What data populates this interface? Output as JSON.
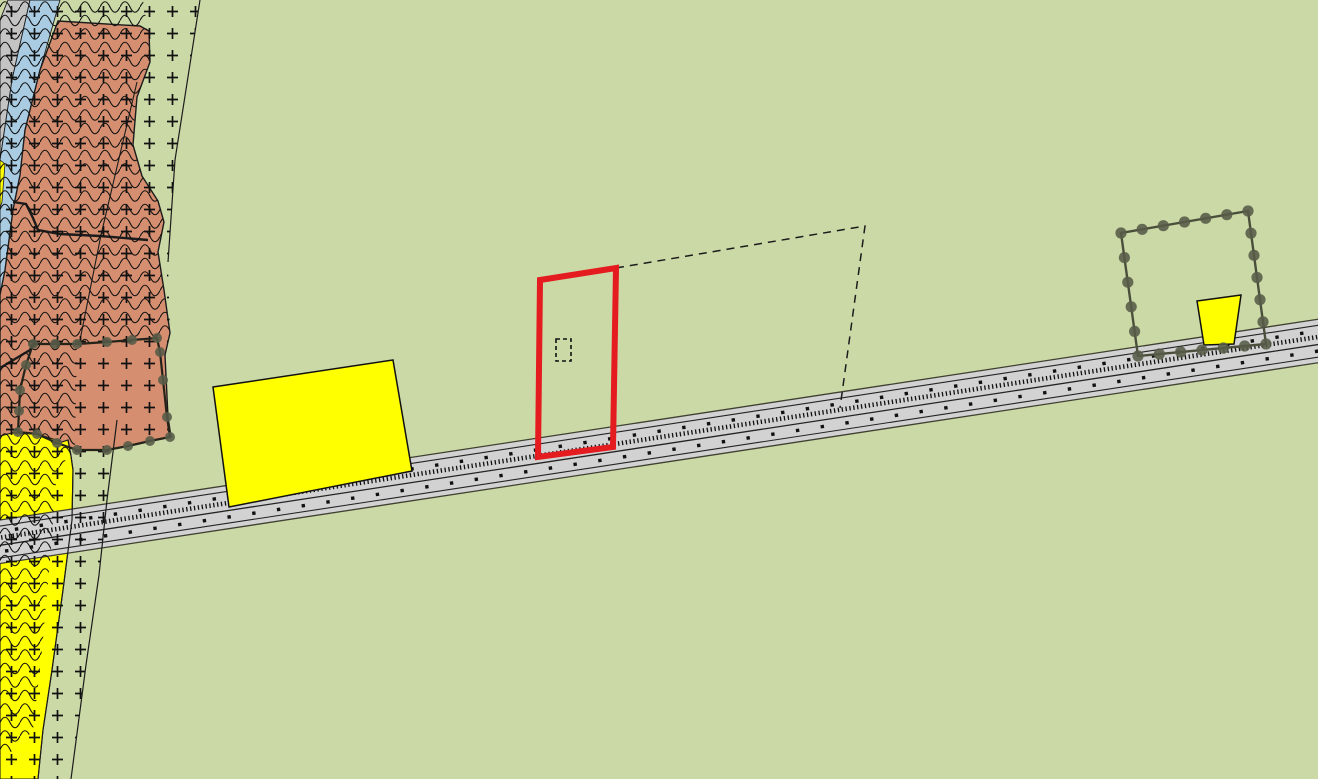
{
  "map": {
    "width": 1318,
    "height": 779,
    "palette": {
      "background_green": "#cbd9a6",
      "zone_gray": "#c4c4c4",
      "zone_blue": "#a9cce3",
      "zone_salmon": "#d58e6f",
      "zone_yellow": "#ffff00",
      "road_gray": "#d2d2d2",
      "line_dark": "#1c1c1c",
      "road_edge_olive": "#3f4031",
      "vertex_dot": "#565b48",
      "selection_red": "#e41b1f"
    },
    "zones": [
      {
        "name": "zone-gray-strip",
        "color": "#c4c4c4",
        "stroke": "#1c1c1c",
        "stroke_width": 0.9,
        "points": [
          [
            8,
            0
          ],
          [
            30,
            0
          ],
          [
            12,
            80
          ],
          [
            3,
            140
          ],
          [
            0,
            160
          ],
          [
            0,
            20
          ]
        ]
      },
      {
        "name": "zone-blue-strip",
        "color": "#a9cce3",
        "stroke": "#1c1c1c",
        "stroke_width": 0.9,
        "points": [
          [
            30,
            0
          ],
          [
            60,
            0
          ],
          [
            40,
            70
          ],
          [
            25,
            130
          ],
          [
            20,
            175
          ],
          [
            13,
            210
          ],
          [
            5,
            270
          ],
          [
            0,
            300
          ],
          [
            0,
            160
          ],
          [
            3,
            140
          ],
          [
            12,
            80
          ]
        ]
      },
      {
        "name": "zone-yellow-sliver",
        "color": "#ffff00",
        "stroke": "#1c1c1c",
        "stroke_width": 0.8,
        "points": [
          [
            0,
            160
          ],
          [
            5,
            164
          ],
          [
            2,
            202
          ],
          [
            0,
            208
          ]
        ]
      },
      {
        "name": "zone-salmon",
        "color": "#d58e6f",
        "stroke": "#1c1c1c",
        "stroke_width": 1.4,
        "points": [
          [
            58,
            21
          ],
          [
            140,
            26
          ],
          [
            149,
            31
          ],
          [
            150,
            62
          ],
          [
            137,
            97
          ],
          [
            133,
            145
          ],
          [
            142,
            176
          ],
          [
            158,
            201
          ],
          [
            164,
            222
          ],
          [
            158,
            252
          ],
          [
            164,
            290
          ],
          [
            170,
            333
          ],
          [
            165,
            355
          ],
          [
            168,
            417
          ],
          [
            171,
            437
          ],
          [
            150,
            441
          ],
          [
            128,
            446
          ],
          [
            107,
            450
          ],
          [
            77,
            450
          ],
          [
            37,
            434
          ],
          [
            12,
            433
          ],
          [
            0,
            437
          ],
          [
            0,
            295
          ],
          [
            5,
            270
          ],
          [
            13,
            210
          ],
          [
            20,
            175
          ],
          [
            25,
            130
          ],
          [
            40,
            70
          ]
        ]
      },
      {
        "name": "zone-yellow-left",
        "color": "#ffff00",
        "stroke": "#1c1c1c",
        "stroke_width": 1.1,
        "points": [
          [
            0,
            436
          ],
          [
            12,
            433
          ],
          [
            37,
            434
          ],
          [
            50,
            438
          ],
          [
            62,
            442
          ],
          [
            68,
            440
          ],
          [
            71,
            456
          ],
          [
            73,
            470
          ],
          [
            72,
            520
          ],
          [
            63,
            590
          ],
          [
            52,
            670
          ],
          [
            43,
            730
          ],
          [
            38,
            779
          ],
          [
            0,
            779
          ]
        ]
      }
    ],
    "boundary_lines_under": [
      {
        "name": "boundary-salmon-inner-upper",
        "width": 1.1,
        "points": [
          [
            137,
            82
          ],
          [
            121,
            150
          ],
          [
            101,
            235
          ],
          [
            86,
            310
          ],
          [
            80,
            340
          ]
        ]
      },
      {
        "name": "boundary-salmon-inner-thick",
        "width": 2.4,
        "points": [
          [
            13,
            202
          ],
          [
            26,
            204
          ],
          [
            33,
            218
          ],
          [
            38,
            230
          ],
          [
            60,
            234
          ],
          [
            100,
            236
          ],
          [
            148,
            240
          ]
        ]
      },
      {
        "name": "boundary-salmon-lower-left",
        "width": 2.4,
        "points": [
          [
            0,
            368
          ],
          [
            30,
            350
          ],
          [
            33,
            344
          ]
        ]
      }
    ],
    "road": {
      "name": "road",
      "angle_deg": -8.66,
      "origin": [
        0,
        520
      ],
      "span": [
        -60,
        1540
      ],
      "band": {
        "top": 0,
        "bottom": 43,
        "fill": "#d2d2d2"
      },
      "lines": [
        {
          "name": "road-outer-top-line",
          "dy": 0,
          "w": 1.3,
          "color": "#3f4031"
        },
        {
          "name": "road-inner-top-line",
          "dy": 6,
          "w": 1.1,
          "color": "#232323"
        },
        {
          "name": "road-tick-line",
          "dy": 17.5,
          "w": 4.6,
          "color": "#111111",
          "dash": "1.3 2.6"
        },
        {
          "name": "road-center-line",
          "dy": 25,
          "w": 1.3,
          "color": "#232323"
        },
        {
          "name": "road-inner-bottom-line",
          "dy": 37.5,
          "w": 1.1,
          "color": "#232323"
        },
        {
          "name": "road-outer-bottom-line",
          "dy": 43,
          "w": 1.3,
          "color": "#3f4031"
        }
      ],
      "dot_rows": [
        {
          "name": "road-dot-row-upper",
          "dy": 11.5,
          "offset": 0,
          "step": 25,
          "size": 3.4
        },
        {
          "name": "road-dot-row-lower",
          "dy": 31.5,
          "offset": 12,
          "step": 25,
          "size": 3.4
        }
      ],
      "dot_color": "#111111"
    },
    "boundary_lines_over": [
      {
        "name": "boundary-plus-zone-top",
        "width": 1.2,
        "points": [
          [
            200,
            0
          ],
          [
            175,
            160
          ],
          [
            168,
            262
          ]
        ]
      },
      {
        "name": "boundary-plus-zone-bottom",
        "width": 1.2,
        "points": [
          [
            117,
            420
          ],
          [
            107,
            500
          ],
          [
            99,
            575
          ],
          [
            86,
            665
          ],
          [
            71,
            779
          ]
        ]
      },
      {
        "name": "boundary-yellow-right-edge",
        "width": 1.2,
        "points": [
          [
            68,
            440
          ],
          [
            71,
            456
          ],
          [
            73,
            470
          ],
          [
            72,
            520
          ],
          [
            63,
            590
          ],
          [
            52,
            670
          ],
          [
            43,
            730
          ],
          [
            38,
            779
          ]
        ]
      }
    ],
    "pattern_overlays": [
      {
        "name": "overlay-plus-hatch",
        "pattern": "plus",
        "points": [
          [
            0,
            0
          ],
          [
            200,
            0
          ],
          [
            175,
            160
          ],
          [
            168,
            262
          ],
          [
            170,
            333
          ],
          [
            165,
            355
          ],
          [
            168,
            417
          ],
          [
            171,
            437
          ],
          [
            150,
            441
          ],
          [
            115,
            441
          ],
          [
            107,
            500
          ],
          [
            99,
            575
          ],
          [
            86,
            665
          ],
          [
            71,
            779
          ],
          [
            0,
            779
          ]
        ]
      },
      {
        "name": "overlay-wave-hatch",
        "pattern": "wave",
        "points": [
          [
            0,
            0
          ],
          [
            143,
            0
          ],
          [
            148,
            31
          ],
          [
            150,
            62
          ],
          [
            137,
            97
          ],
          [
            133,
            145
          ],
          [
            142,
            176
          ],
          [
            158,
            201
          ],
          [
            164,
            222
          ],
          [
            158,
            252
          ],
          [
            164,
            290
          ],
          [
            170,
            333
          ],
          [
            157,
            338
          ],
          [
            107,
            342
          ],
          [
            77,
            344
          ],
          [
            75,
            450
          ],
          [
            57,
            470
          ],
          [
            50,
            560
          ],
          [
            42,
            650
          ],
          [
            33,
            730
          ],
          [
            18,
            748
          ],
          [
            0,
            758
          ]
        ]
      }
    ],
    "buildings": [
      {
        "name": "building-yellow-large",
        "color": "#ffff00",
        "stroke": "#111111",
        "stroke_width": 1.5,
        "points": [
          [
            213,
            387
          ],
          [
            393,
            360
          ],
          [
            412,
            471
          ],
          [
            229,
            507
          ]
        ]
      },
      {
        "name": "building-yellow-small",
        "color": "#ffff00",
        "stroke": "#111111",
        "stroke_width": 1.5,
        "points": [
          [
            1197,
            301
          ],
          [
            1241,
            295
          ],
          [
            1234,
            344
          ],
          [
            1204,
            345
          ]
        ]
      }
    ],
    "dashed_parcel": {
      "name": "dashed-parcel-outline",
      "color": "#1c1c1c",
      "width": 1.5,
      "dash": "8 6",
      "points": [
        [
          616,
          268
        ],
        [
          865,
          226
        ],
        [
          840,
          408
        ]
      ]
    },
    "selection": {
      "name": "selected-parcel-highlight",
      "color": "#e41b1f",
      "width": 6,
      "points": [
        [
          540,
          280
        ],
        [
          616,
          268
        ],
        [
          613,
          447
        ],
        [
          538,
          457
        ]
      ],
      "inner_dashed_rect": {
        "name": "selection-inner-dashed-rect",
        "x": 556,
        "y": 339,
        "w": 15,
        "h": 22,
        "color": "#111111",
        "width": 1.6,
        "dash": "4 3"
      }
    },
    "vertex_parcels": [
      {
        "name": "vertex-parcel-salmon",
        "stroke": "#23231a",
        "width": 2.2,
        "dot_color": "#565b48",
        "dot_r": 5.0,
        "dot_spacing": 26,
        "points": [
          [
            33,
            344
          ],
          [
            77,
            344
          ],
          [
            107,
            342
          ],
          [
            132,
            340
          ],
          [
            157,
            338
          ],
          [
            160,
            352
          ],
          [
            163,
            380
          ],
          [
            167,
            417
          ],
          [
            170,
            437
          ],
          [
            150,
            441
          ],
          [
            128,
            446
          ],
          [
            107,
            450
          ],
          [
            77,
            450
          ],
          [
            57,
            443
          ],
          [
            37,
            434
          ],
          [
            18,
            432
          ],
          [
            20,
            390
          ],
          [
            26,
            365
          ]
        ]
      },
      {
        "name": "vertex-parcel-right",
        "stroke": "#4a4f3c",
        "width": 2.4,
        "dot_color": "#565b48",
        "dot_r": 5.6,
        "dot_spacing": 23,
        "points": [
          [
            1121,
            233
          ],
          [
            1248,
            211
          ],
          [
            1266,
            344
          ],
          [
            1138,
            356
          ]
        ]
      }
    ]
  }
}
